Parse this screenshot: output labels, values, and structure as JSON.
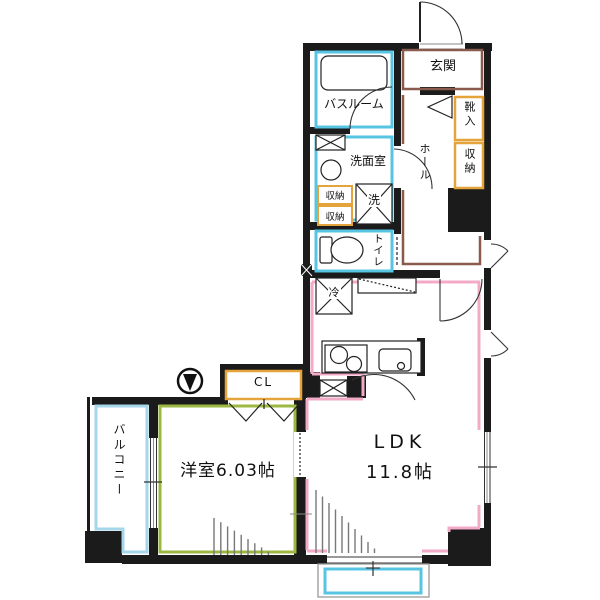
{
  "plan_title": "apartment-floor-plan",
  "rooms": {
    "genkan": "玄関",
    "bathroom": "バスルーム",
    "washroom": "洗面室",
    "storage_a": "収納",
    "storage_b": "収納",
    "washer": "洗",
    "toilet": "トイレ",
    "hall": "ホール",
    "shoebox": "靴入",
    "storage_tall": "収納",
    "fridge": "冷",
    "closet": "CL",
    "ldk_name": "LDK",
    "ldk_size": "11.8帖",
    "western_room": "洋室6.03帖",
    "balcony": "バルコニー"
  },
  "colors": {
    "wall": "#1b1b1b",
    "water_cyan": "#57c4e4",
    "balcony_cyan": "#a5d6ea",
    "storage_orange": "#e5a33c",
    "entry_brown": "#8a5a4c",
    "ldk_pink": "#f3aac6",
    "room_green": "#9cb842"
  },
  "icons": [
    "bathtub",
    "toilet",
    "wash-sink",
    "stove-burners",
    "kitchen-sink",
    "refrigerator",
    "washer-pan",
    "duct-box",
    "meter-valve",
    "door-swing-arc",
    "casement-window",
    "sliding-window",
    "folding-door",
    "entrance-door"
  ]
}
